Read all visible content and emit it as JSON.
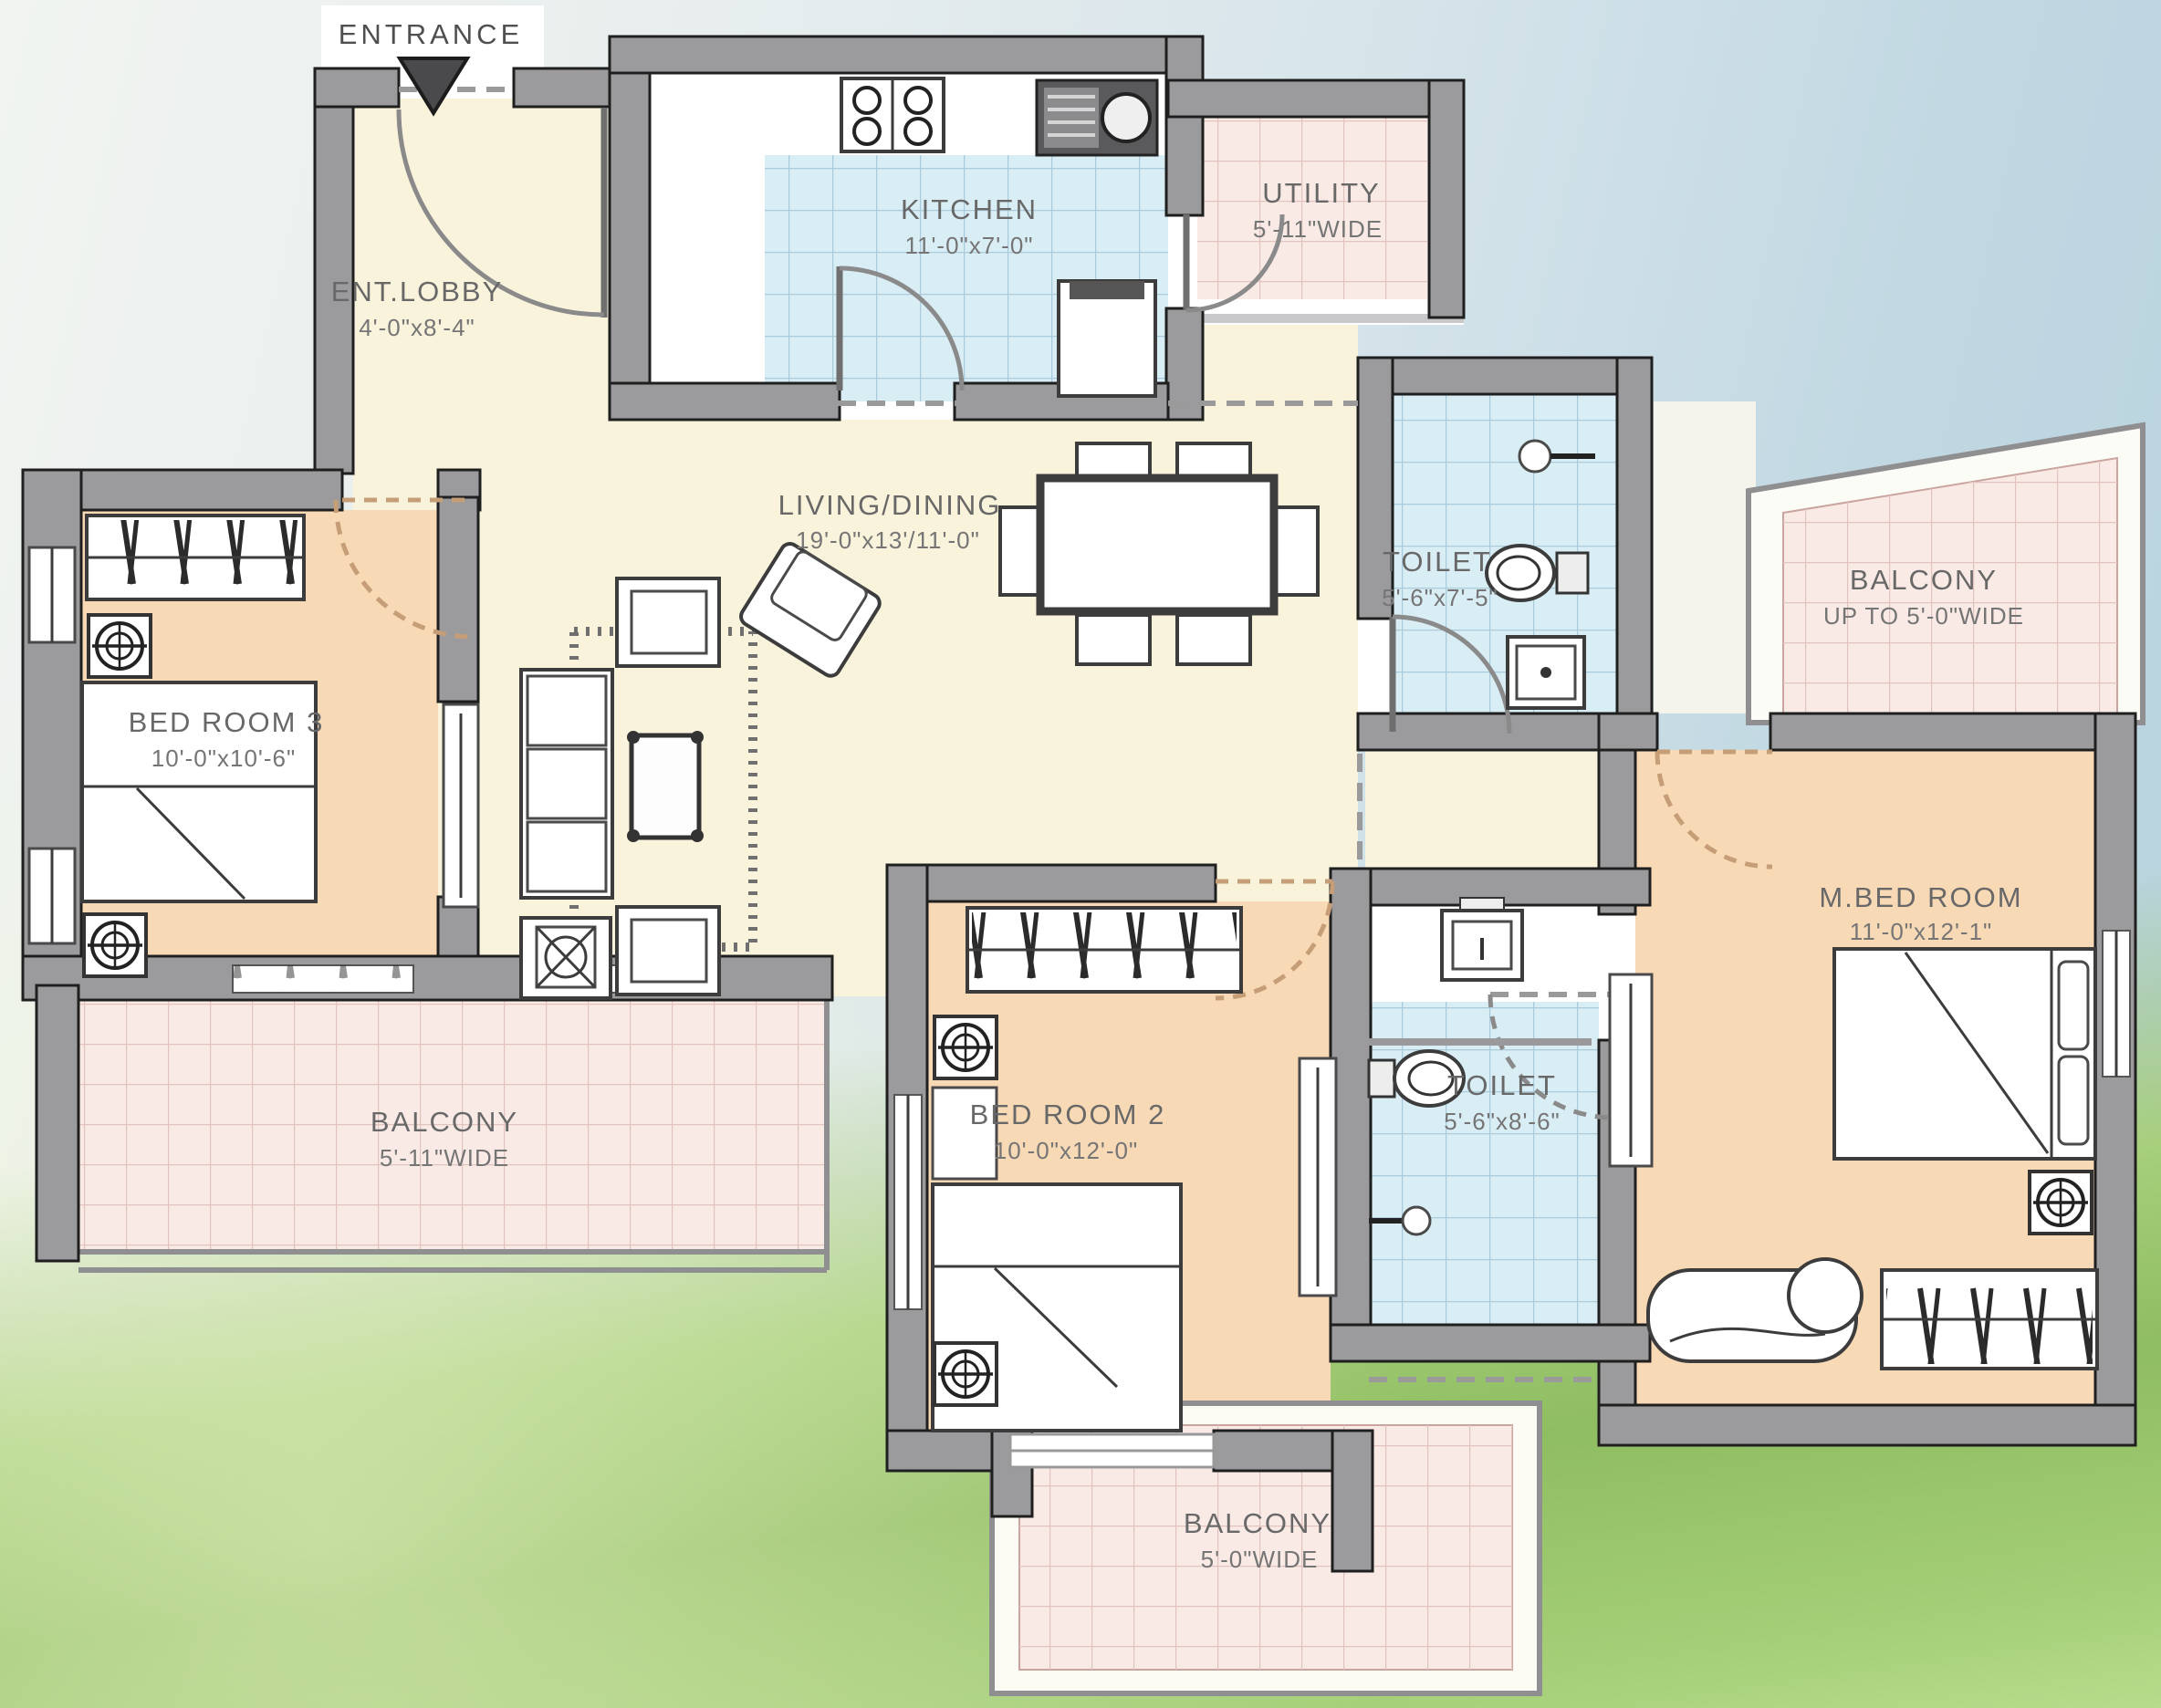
{
  "plan": {
    "entrance_label": "ENTRANCE",
    "rooms": [
      {
        "name": "ENT.LOBBY",
        "dims": "4'-0\"x8'-4\""
      },
      {
        "name": "KITCHEN",
        "dims": "11'-0\"x7'-0\""
      },
      {
        "name": "UTILITY",
        "dims": "5'-11\"WIDE"
      },
      {
        "name": "LIVING/DINING",
        "dims": "19'-0\"x13'/11'-0\""
      },
      {
        "name": "BED ROOM 3",
        "dims": "10'-0\"x10'-6\""
      },
      {
        "name": "TOILET",
        "dims": "5'-6\"x7'-5\""
      },
      {
        "name": "BALCONY",
        "dims": "UP TO 5'-0\"WIDE"
      },
      {
        "name": "M.BED ROOM",
        "dims": "11'-0\"x12'-1\""
      },
      {
        "name": "BED ROOM 2",
        "dims": "10'-0\"x12'-0\""
      },
      {
        "name": "TOILET",
        "dims": "5'-6\"x8'-6\""
      },
      {
        "name": "BALCONY",
        "dims": "5'-11\"WIDE"
      },
      {
        "name": "BALCONY",
        "dims": "5'-0\"WIDE"
      }
    ],
    "colors": {
      "wall": "#9b9b9d",
      "floor_cream": "#faf3dc",
      "floor_peach": "#f8d9b6",
      "floor_blue": "#d9edf5",
      "floor_pink": "#faeae6",
      "label": "#686868"
    }
  }
}
